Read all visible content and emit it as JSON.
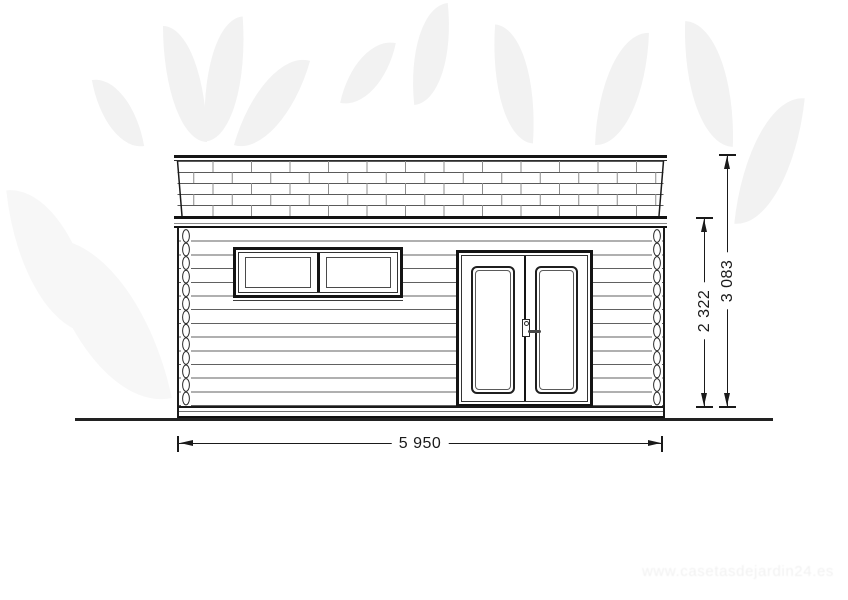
{
  "drawing": {
    "line_color": "#1a1a1a",
    "background_color": "#ffffff"
  },
  "dimensions": {
    "width_mm": "5 950",
    "wall_height_mm": "2 322",
    "total_height_mm": "3 083"
  },
  "watermark": {
    "leaf_motif_color": "#f2f2f2",
    "url_text": "www.casetasdejardin24.es"
  }
}
